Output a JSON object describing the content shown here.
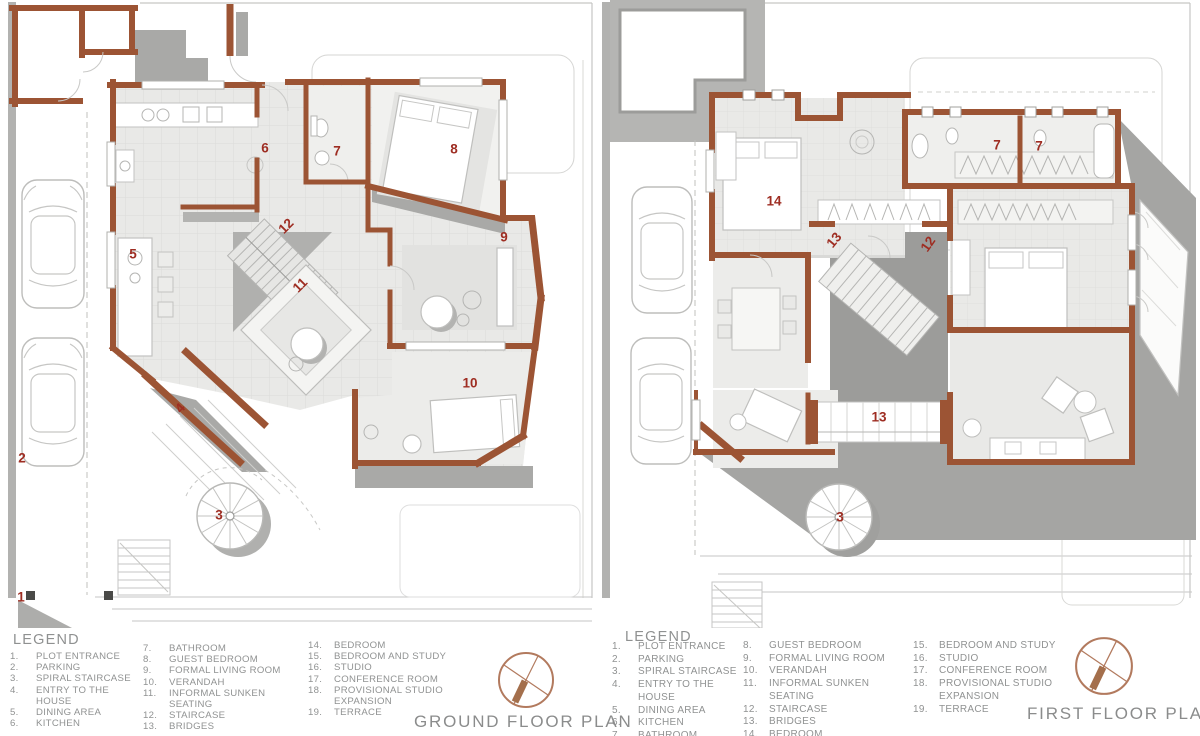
{
  "document": {
    "type": "architectural floor plans",
    "sheet_background": "#ffffff"
  },
  "colors": {
    "wall": "#9c5434",
    "plan_number": "#9e2d22",
    "shadow": "#a5a5a3",
    "floor": "#e9e9e7",
    "site_line": "#c6c6c4",
    "legend_text": "#909292",
    "title_text": "#8b8c8c",
    "compass": "#b27a5e"
  },
  "plans": [
    {
      "title": "GROUND FLOOR PLAN",
      "legend_title": "LEGEND",
      "legend_cols": [
        [
          [
            "1.",
            "PLOT ENTRANCE"
          ],
          [
            "2.",
            "PARKING"
          ],
          [
            "3.",
            "SPIRAL STAIRCASE"
          ],
          [
            "4.",
            "ENTRY TO THE HOUSE"
          ],
          [
            "5.",
            "DINING AREA"
          ],
          [
            "6.",
            "KITCHEN"
          ]
        ],
        [
          [
            "7.",
            "BATHROOM"
          ],
          [
            "8.",
            "GUEST BEDROOM"
          ],
          [
            "9.",
            "FORMAL LIVING ROOM"
          ],
          [
            "10.",
            "VERANDAH"
          ],
          [
            "11.",
            "INFORMAL SUNKEN SEATING"
          ],
          [
            "12.",
            "STAIRCASE"
          ],
          [
            "13.",
            "BRIDGES"
          ]
        ],
        [
          [
            "14.",
            "BEDROOM"
          ],
          [
            "15.",
            "BEDROOM AND STUDY"
          ],
          [
            "16.",
            "STUDIO"
          ],
          [
            "17.",
            "CONFERENCE ROOM"
          ],
          [
            "18.",
            "PROVISIONAL STUDIO EXPANSION"
          ],
          [
            "19.",
            "TERRACE"
          ]
        ]
      ],
      "labels": [
        {
          "t": "1",
          "x": 21,
          "y": 597,
          "r": 0
        },
        {
          "t": "2",
          "x": 22,
          "y": 458,
          "r": 0
        },
        {
          "t": "3",
          "x": 219,
          "y": 515,
          "r": 0
        },
        {
          "t": "4",
          "x": 180,
          "y": 408,
          "r": -47
        },
        {
          "t": "5",
          "x": 133,
          "y": 254,
          "r": 0
        },
        {
          "t": "6",
          "x": 265,
          "y": 148,
          "r": 0
        },
        {
          "t": "7",
          "x": 337,
          "y": 151,
          "r": 0
        },
        {
          "t": "8",
          "x": 454,
          "y": 149,
          "r": 0
        },
        {
          "t": "9",
          "x": 504,
          "y": 237,
          "r": 0
        },
        {
          "t": "10",
          "x": 470,
          "y": 383,
          "r": 0
        },
        {
          "t": "11",
          "x": 300,
          "y": 285,
          "r": -45
        },
        {
          "t": "12",
          "x": 286,
          "y": 226,
          "r": -45
        }
      ]
    },
    {
      "title": "FIRST FLOOR PLAN",
      "legend_title": "LEGEND",
      "legend_cols": [
        [
          [
            "1.",
            "PLOT ENTRANCE"
          ],
          [
            "2.",
            "PARKING"
          ],
          [
            "3.",
            "SPIRAL STAIRCASE"
          ],
          [
            "4.",
            "ENTRY TO THE HOUSE"
          ],
          [
            "5.",
            "DINING AREA"
          ],
          [
            "6.",
            "KITCHEN"
          ],
          [
            "7.",
            "BATHROOM"
          ]
        ],
        [
          [
            "8.",
            "GUEST BEDROOM"
          ],
          [
            "9.",
            "FORMAL LIVING ROOM"
          ],
          [
            "10.",
            "VERANDAH"
          ],
          [
            "11.",
            "INFORMAL SUNKEN SEATING"
          ],
          [
            "12.",
            "STAIRCASE"
          ],
          [
            "13.",
            "BRIDGES"
          ],
          [
            "14.",
            "BEDROOM"
          ]
        ],
        [
          [
            "15.",
            "BEDROOM AND STUDY"
          ],
          [
            "16.",
            "STUDIO"
          ],
          [
            "17.",
            "CONFERENCE ROOM"
          ],
          [
            "18.",
            "PROVISIONAL STUDIO EXPANSION"
          ],
          [
            "19.",
            "TERRACE"
          ]
        ]
      ],
      "labels": [
        {
          "t": "14",
          "x": 174,
          "y": 201,
          "r": 0
        },
        {
          "t": "13",
          "x": 234,
          "y": 240,
          "r": -50
        },
        {
          "t": "12",
          "x": 328,
          "y": 244,
          "r": -55
        },
        {
          "t": "7",
          "x": 397,
          "y": 145,
          "r": 0
        },
        {
          "t": "7",
          "x": 439,
          "y": 146,
          "r": 0
        },
        {
          "t": "13",
          "x": 279,
          "y": 417,
          "r": 0
        },
        {
          "t": "3",
          "x": 240,
          "y": 517,
          "r": 0
        }
      ]
    }
  ]
}
